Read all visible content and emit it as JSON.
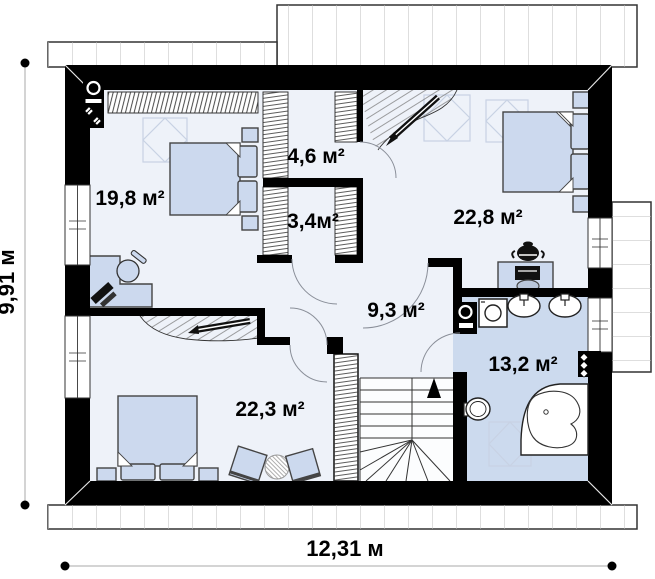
{
  "plan": {
    "type": "attic-floor-plan",
    "rooms": [
      {
        "id": "bedroom-top-left",
        "area_label": "19,8 м²"
      },
      {
        "id": "closet-top",
        "area_label": "4,6 м²"
      },
      {
        "id": "closet-middle",
        "area_label": "3,4м²"
      },
      {
        "id": "bedroom-top-right",
        "area_label": "22,8 м²"
      },
      {
        "id": "hall",
        "area_label": "9,3 м²"
      },
      {
        "id": "bedroom-bottom-left",
        "area_label": "22,3 м²"
      },
      {
        "id": "bathroom",
        "area_label": "13,2 м²"
      }
    ],
    "dimensions": {
      "height_label": "9,91 м",
      "width_label": "12,31 м"
    },
    "colors": {
      "wall": "#000000",
      "floor": "#eef2f9",
      "bathroom_floor": "#ccdaee",
      "furniture_fill": "#ccd9ee",
      "eaves_line": "#b5b5b5"
    },
    "icons": [
      "double-bed-icon",
      "wardrobe-icon",
      "desk-icon",
      "office-chair-icon",
      "stairs-icon",
      "stairs-up-arrow-icon",
      "toilet-icon",
      "corner-bathtub-icon",
      "washing-machine-icon",
      "sink-icon",
      "boiler-icon",
      "vent-stack-icon",
      "chimney-icon",
      "armchair-icon",
      "coffee-table-icon",
      "roof-window-icon",
      "roof-slope-icon"
    ]
  }
}
